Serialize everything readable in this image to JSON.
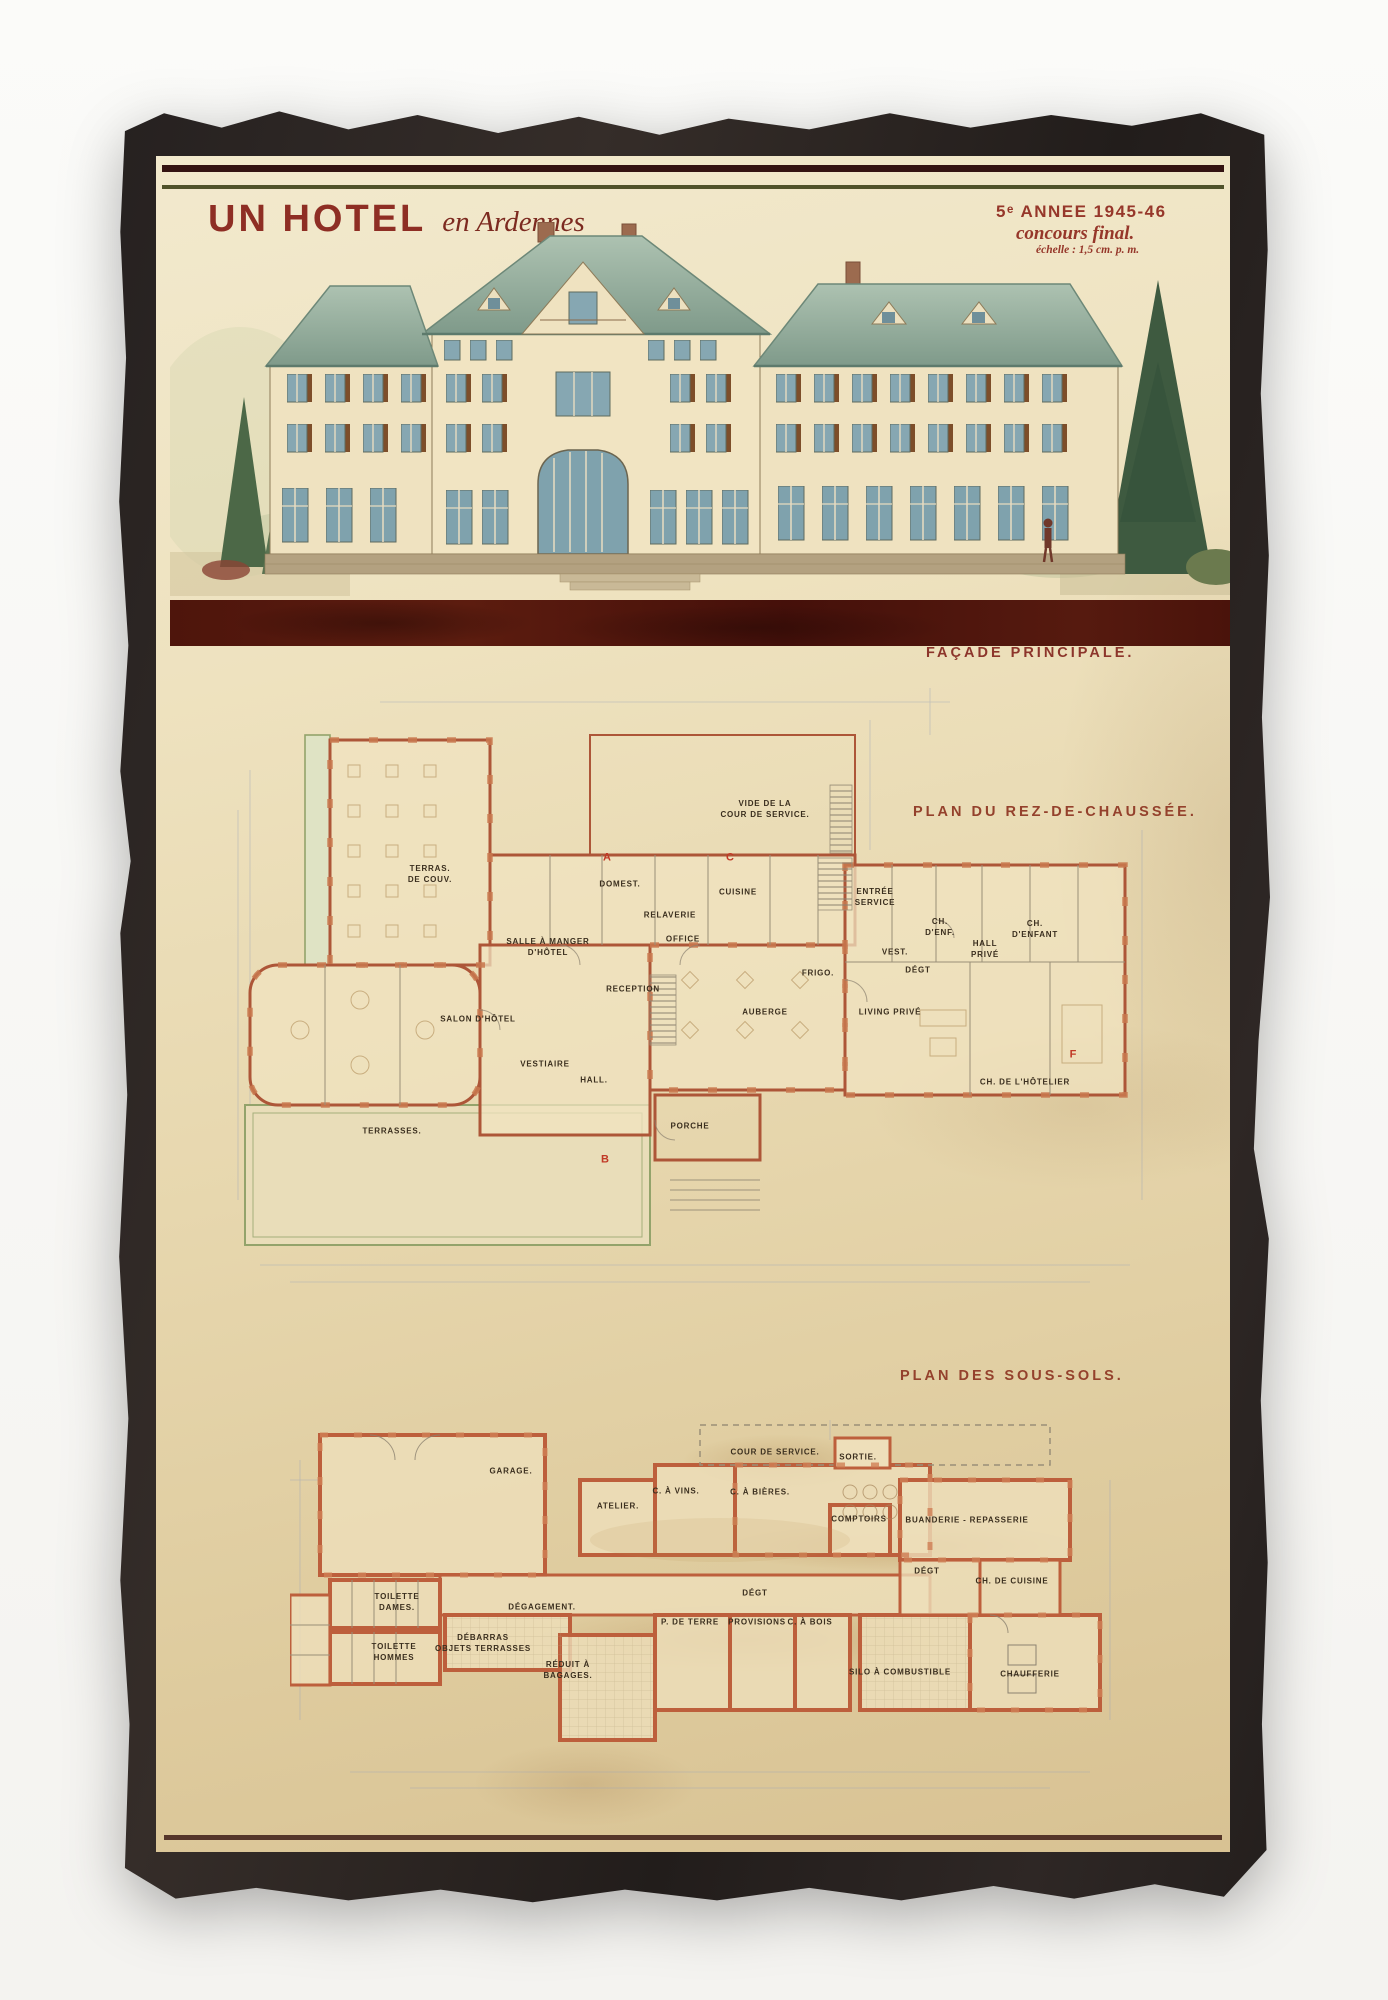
{
  "poster": {
    "title_main": "UN HOTEL",
    "title_sub": "en Ardennes",
    "stamp": {
      "line1": "5ᵉ ANNEE 1945-46",
      "line2": "concours final.",
      "line3": "échelle : 1,5 cm. p. m."
    },
    "facade_caption": "FAÇADE PRINCIPALE.",
    "plans": [
      {
        "caption": "PLAN DU REZ-DE-CHAUSSÉE.",
        "rooms": [
          {
            "label": "TERRAS.\nDE COUV.",
            "x": 274,
            "y": 719
          },
          {
            "label": "SALLE À MANGER\nD'HÔTEL",
            "x": 392,
            "y": 792
          },
          {
            "label": "DOMEST.",
            "x": 464,
            "y": 729
          },
          {
            "label": "RELAVERIE",
            "x": 514,
            "y": 760
          },
          {
            "label": "OFFICE",
            "x": 527,
            "y": 784
          },
          {
            "label": "CUISINE",
            "x": 582,
            "y": 737
          },
          {
            "label": "VIDE DE LA\nCOUR DE SERVICE.",
            "x": 609,
            "y": 654
          },
          {
            "label": "ENTRÉE\nSERVICE",
            "x": 719,
            "y": 742
          },
          {
            "label": "FRIGO.",
            "x": 662,
            "y": 818
          },
          {
            "label": "RECEPTION",
            "x": 477,
            "y": 834
          },
          {
            "label": "VEST.",
            "x": 739,
            "y": 797
          },
          {
            "label": "DÉGT",
            "x": 762,
            "y": 815
          },
          {
            "label": "CH.\nD'ENF.",
            "x": 784,
            "y": 772
          },
          {
            "label": "HALL\nPRIVÉ",
            "x": 829,
            "y": 794
          },
          {
            "label": "CH.\nD'ENFANT",
            "x": 879,
            "y": 774
          },
          {
            "label": "AUBERGE",
            "x": 609,
            "y": 857
          },
          {
            "label": "LIVING PRIVÉ",
            "x": 734,
            "y": 857
          },
          {
            "label": "CH. DE L'HÔTELIER",
            "x": 869,
            "y": 927
          },
          {
            "label": "SALON D'HÔTEL",
            "x": 322,
            "y": 864
          },
          {
            "label": "VESTIAIRE",
            "x": 389,
            "y": 909
          },
          {
            "label": "HALL.",
            "x": 438,
            "y": 925
          },
          {
            "label": "TERRASSES.",
            "x": 236,
            "y": 976
          },
          {
            "label": "PORCHE",
            "x": 534,
            "y": 971
          }
        ],
        "markers": [
          {
            "label": "A",
            "x": 451,
            "y": 702,
            "red": true
          },
          {
            "label": "C",
            "x": 574,
            "y": 702,
            "red": true
          },
          {
            "label": "B",
            "x": 449,
            "y": 1004,
            "red": true
          },
          {
            "label": "F",
            "x": 917,
            "y": 899,
            "red": true
          }
        ]
      },
      {
        "caption": "PLAN DES SOUS-SOLS.",
        "rooms": [
          {
            "label": "GARAGE.",
            "x": 355,
            "y": 1316
          },
          {
            "label": "COUR DE SERVICE.",
            "x": 619,
            "y": 1297
          },
          {
            "label": "SORTIE.",
            "x": 702,
            "y": 1302
          },
          {
            "label": "C. À VINS.",
            "x": 520,
            "y": 1336
          },
          {
            "label": "C. À BIÈRES.",
            "x": 604,
            "y": 1337
          },
          {
            "label": "ATELIER.",
            "x": 462,
            "y": 1351
          },
          {
            "label": "COMPTOIRS",
            "x": 703,
            "y": 1364
          },
          {
            "label": "BUANDERIE - REPASSERIE",
            "x": 811,
            "y": 1365
          },
          {
            "label": "DÉGT",
            "x": 771,
            "y": 1416
          },
          {
            "label": "CH. DE CUISINE",
            "x": 856,
            "y": 1426
          },
          {
            "label": "DÉGAGEMENT.",
            "x": 386,
            "y": 1452
          },
          {
            "label": "DÉGT",
            "x": 599,
            "y": 1438
          },
          {
            "label": "TOILETTE\nDAMES.",
            "x": 241,
            "y": 1447
          },
          {
            "label": "TOILETTE\nHOMMES",
            "x": 238,
            "y": 1497
          },
          {
            "label": "DÉBARRAS\nOBJETS TERRASSES",
            "x": 327,
            "y": 1488
          },
          {
            "label": "RÉDUIT À\nBAGAGES.",
            "x": 412,
            "y": 1515
          },
          {
            "label": "P. DE TERRE",
            "x": 534,
            "y": 1467
          },
          {
            "label": "PROVISIONS",
            "x": 601,
            "y": 1467
          },
          {
            "label": "C. À BOIS",
            "x": 654,
            "y": 1467
          },
          {
            "label": "SILO À COMBUSTIBLE",
            "x": 744,
            "y": 1517
          },
          {
            "label": "CHAUFFERIE",
            "x": 874,
            "y": 1519
          }
        ],
        "markers": []
      }
    ],
    "colors": {
      "paper": "#e9dab4",
      "frame_black": "#2b2523",
      "accent_red": "#8e2e24",
      "band_maroon": "#4e150c",
      "plan_wall_terracotta": "#ad5638",
      "roof_teal": "#9fb5a4",
      "terrace_green": "#93a36b"
    }
  }
}
